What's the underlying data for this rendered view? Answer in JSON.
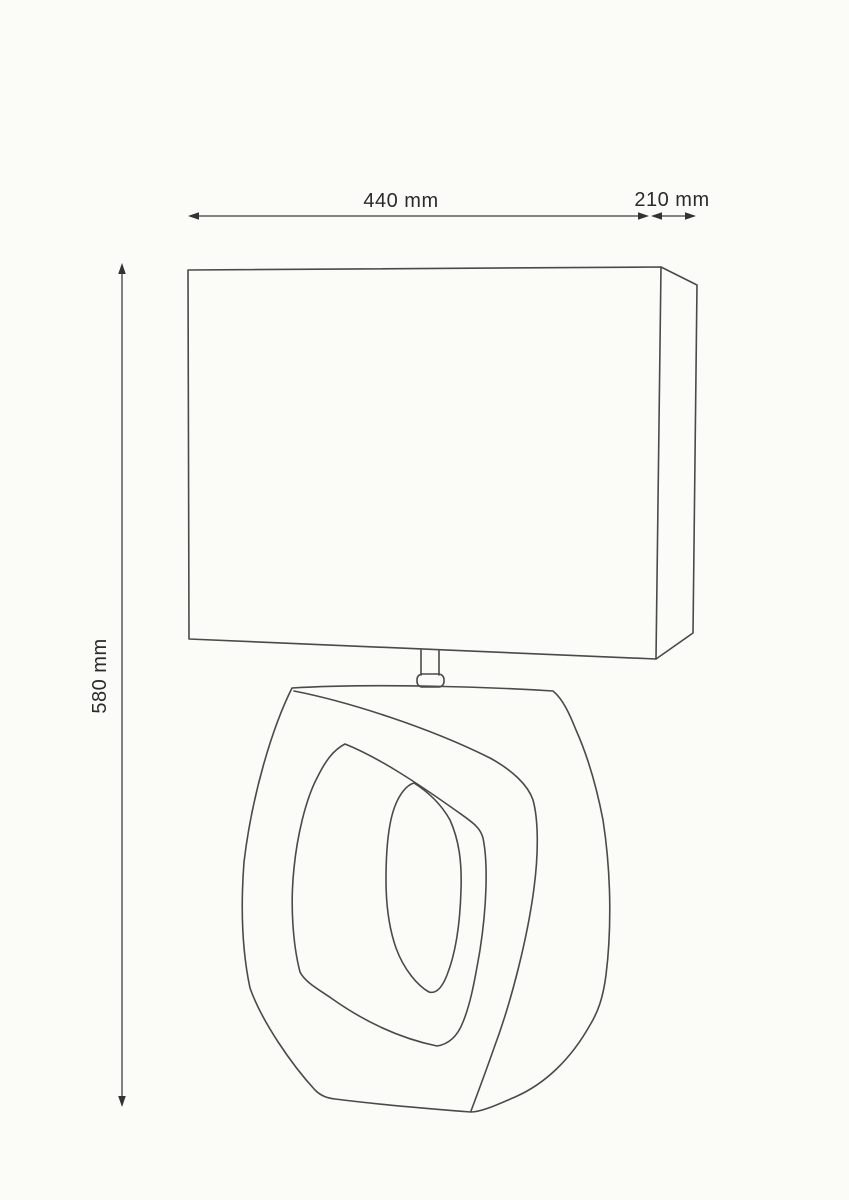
{
  "drawing": {
    "type": "technical dimension drawing",
    "subject": "table lamp with rectangular shade and organic ring-shaped ceramic base",
    "dimensions": {
      "width_label": "440 mm",
      "depth_label": "210 mm",
      "height_label": "580 mm"
    },
    "colors": {
      "background": "#fbfbf8",
      "line": "#4a4a4a",
      "dimension_line": "#3f3f3f",
      "text": "#2b2b2b"
    }
  }
}
